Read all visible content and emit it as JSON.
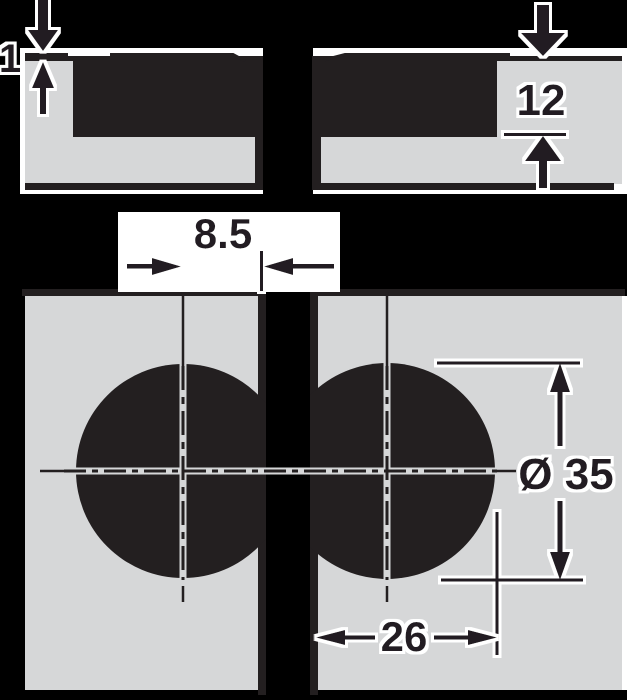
{
  "drawing": {
    "type": "technical-dimension-diagram",
    "colors": {
      "background": "#000000",
      "paper": "#ffffff",
      "ink": "#231f20",
      "panel_fill": "#d6d7d8"
    },
    "labels": {
      "rim_protrusion": "1",
      "cup_depth": "12",
      "drilling_distance": "8.5",
      "cup_diameter": "Ø 35",
      "edge_to_bore_edge": "26"
    }
  }
}
